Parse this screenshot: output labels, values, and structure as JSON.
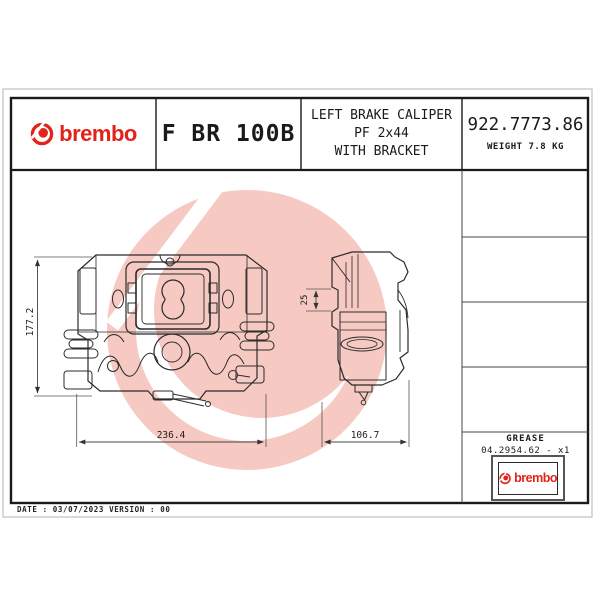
{
  "header": {
    "brand_wordmark": "brembo",
    "model_code": "F BR 100B",
    "description": [
      "LEFT BRAKE CALIPER",
      "PF 2x44",
      "WITH BRACKET"
    ],
    "part_number": "922.7773.86",
    "weight_label": "WEIGHT 7.8 KG"
  },
  "drawing": {
    "front_view": {
      "height_mm": "177.2",
      "width_mm": "236.4"
    },
    "side_view": {
      "width_mm": "106.7",
      "pad_offset_mm": "25"
    }
  },
  "parts_panel": {
    "grease_label": "GREASE",
    "grease_part": "04.2954.62 - x1",
    "brand_wordmark": "brembo"
  },
  "footer": {
    "revision_line": "DATE : 03/07/2023 VERSION : 00"
  },
  "colors": {
    "brand_red": "#e2231a",
    "watermark_pink": "#f6c9c2",
    "line_dark": "#2b2b2b"
  }
}
